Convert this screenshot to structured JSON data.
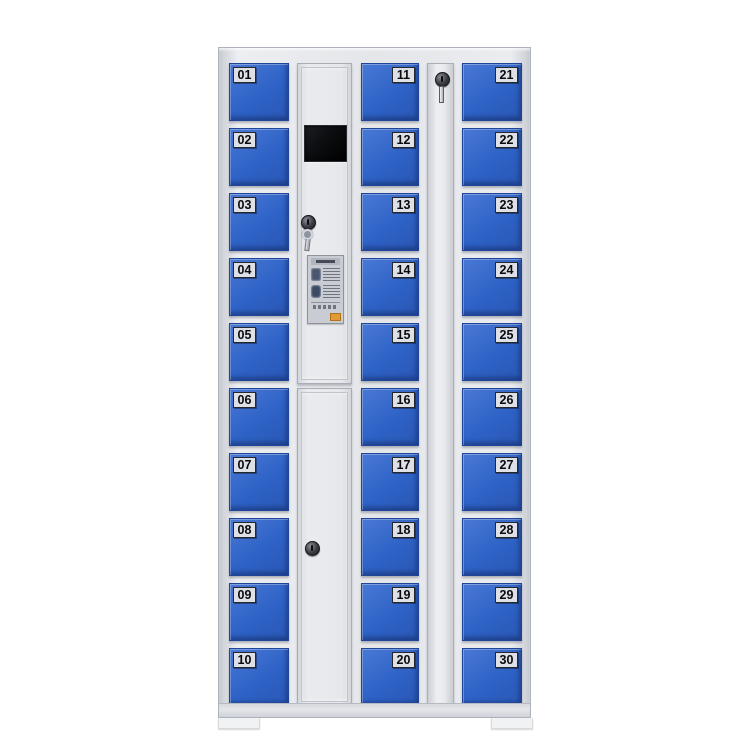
{
  "scene": {
    "background": "#ffffff",
    "description": "30-door blue electronic storage locker cabinet, front view product photo"
  },
  "cabinet": {
    "locker_columns": [
      {
        "position": "left",
        "label_side": "left",
        "doors": [
          "01",
          "02",
          "03",
          "04",
          "05",
          "06",
          "07",
          "08",
          "09",
          "10"
        ]
      },
      {
        "position": "center",
        "label_side": "right",
        "doors": [
          "11",
          "12",
          "13",
          "14",
          "15",
          "16",
          "17",
          "18",
          "19",
          "20"
        ]
      },
      {
        "position": "right",
        "label_side": "right",
        "doors": [
          "21",
          "22",
          "23",
          "24",
          "25",
          "26",
          "27",
          "28",
          "29",
          "30"
        ]
      }
    ],
    "control_column": {
      "screen": "blank-black-display",
      "top_lock": "keylock-with-inserted-key",
      "bottom_lock": "keylock",
      "instruction_sticker": "usage-instructions-label-illegible"
    },
    "side_column": {
      "lock": "keylock-with-inserted-key"
    },
    "colors": {
      "door_blue": "#2e62c6",
      "door_blue_light": "#4a79d6",
      "door_blue_edge": "#1f459a",
      "body": "#e4e6ea",
      "body_dark": "#c9ccd3",
      "frame_line": "#aeb2bb",
      "plate_bg": "#dde0e7",
      "plate_border": "#26272b",
      "plate_text": "#0a0a0b",
      "screen_black": "#0c0d10",
      "sticker_badge": "#e09a36",
      "foot": "#f1f2f4"
    }
  }
}
